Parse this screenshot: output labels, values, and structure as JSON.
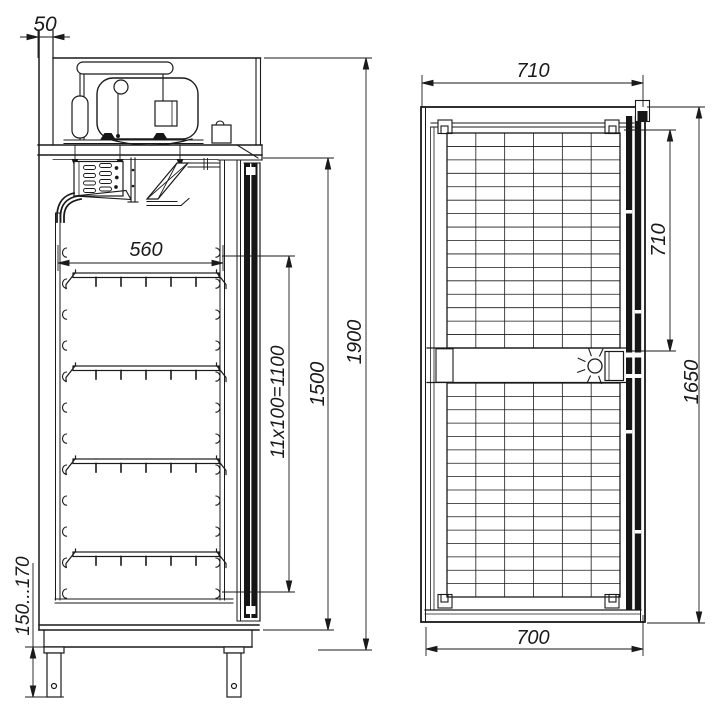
{
  "page": {
    "background": "#ffffff",
    "line_color": "#1a1a1a"
  },
  "drawing": {
    "type": "technical-dimension-drawing",
    "subject": "upright refrigerated cabinet, side section view and front view",
    "units": "mm"
  },
  "side_view": {
    "shelf_count": 4,
    "labels": {
      "rear_clearance": "50",
      "shelf_width": "560",
      "shelf_rail_pitch": "11x100=1100",
      "interior_height": "1500",
      "overall_height": "1900",
      "leg_height_range": "150...170"
    }
  },
  "front_view": {
    "labels": {
      "overall_width": "710",
      "upper_door_height": "710",
      "body_height": "1650",
      "bottom_width": "700"
    }
  }
}
